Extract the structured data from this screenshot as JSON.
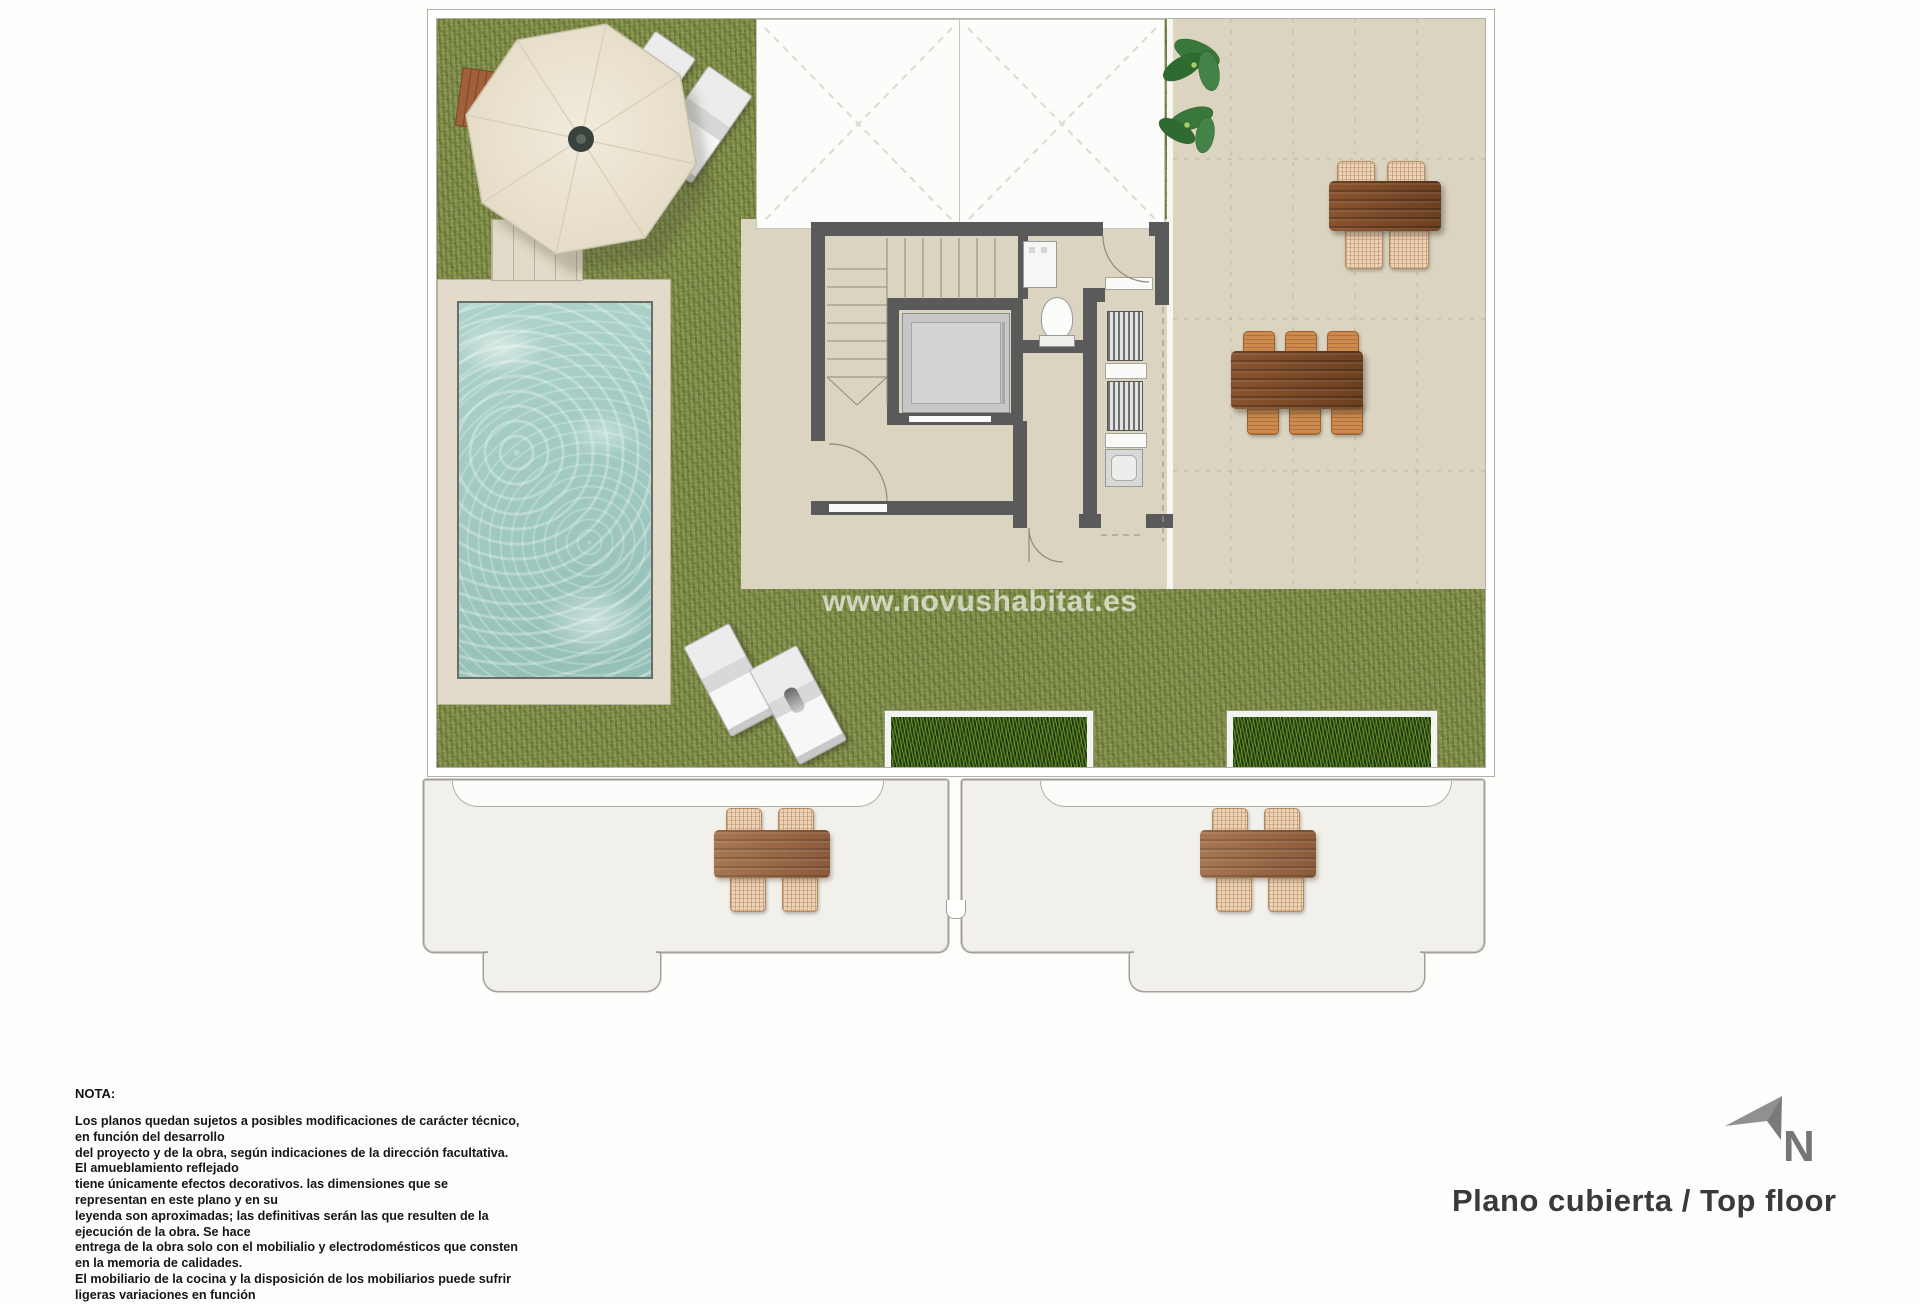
{
  "watermark": {
    "text": "www.novushabitat.es"
  },
  "nota": {
    "title": "NOTA:",
    "lines": [
      "Los planos quedan sujetos a posibles modificaciones de carácter técnico, en función del desarrollo",
      "del proyecto y de la obra, según indicaciones de la dirección facultativa. El amueblamiento reflejado",
      "tiene únicamente efectos decorativos. las dimensiones que se representan en este plano y en su",
      "leyenda son aproximadas; las definitivas serán las que resulten de la ejecución de la obra. Se hace",
      "entrega de la obra solo con el mobilialio y electrodomésticos que consten en la memoria de calidades.",
      "El mobiliario de la cocina y la disposición de los mobiliarios puede sufrir ligeras variaciones en función"
    ]
  },
  "compass": {
    "north_label": "N"
  },
  "footer": {
    "title": "Plano cubierta / Top floor"
  },
  "colors": {
    "grass": "#85914f",
    "terrace_tile": "#dbd4c1",
    "wall": "#5a5a5a",
    "pool_water": "#a3ccc2",
    "wood_table": "#7c4a28",
    "planter_green": "#24330f"
  }
}
